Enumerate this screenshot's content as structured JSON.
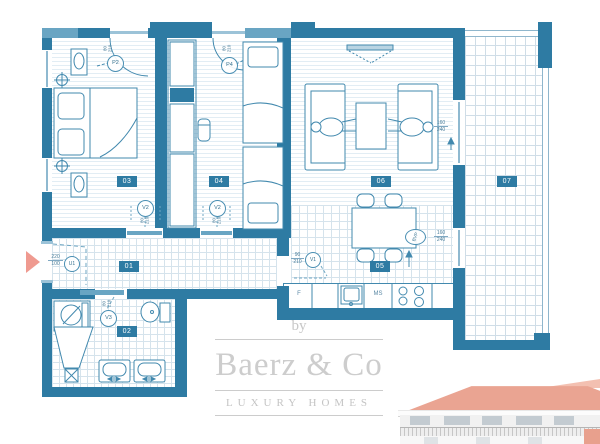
{
  "branding": {
    "prefix": "by",
    "name": "Baerz & Co",
    "tagline": "LUXURY HOMES"
  },
  "rooms": [
    "01",
    "02",
    "03",
    "04",
    "05",
    "06",
    "07"
  ],
  "markers": [
    {
      "label": "P2",
      "w": "80",
      "h": "210"
    },
    {
      "label": "P4",
      "w": "80",
      "h": "210"
    },
    {
      "label": "V2",
      "w": "80",
      "h": "210"
    },
    {
      "label": "V2",
      "w": "80",
      "h": "210"
    },
    {
      "label": "V3",
      "w": "80",
      "h": "210"
    },
    {
      "label": "U1",
      "w": "220",
      "h": "100"
    },
    {
      "label": "V1",
      "w": "90",
      "h": "210"
    },
    {
      "label": "BVP",
      "w": "160",
      "h": "240"
    }
  ],
  "dimensions": {
    "living_window": {
      "w": "160",
      "h": "240"
    }
  },
  "kitchen": {
    "fridge": "F",
    "dishwasher": "MS"
  },
  "colors": {
    "wall": "#2e7ba3",
    "window": "#69a5c3",
    "pink_arrow": "#ef9a90",
    "roof": "#eaa492",
    "logo_gray": "#c7c7c7"
  }
}
